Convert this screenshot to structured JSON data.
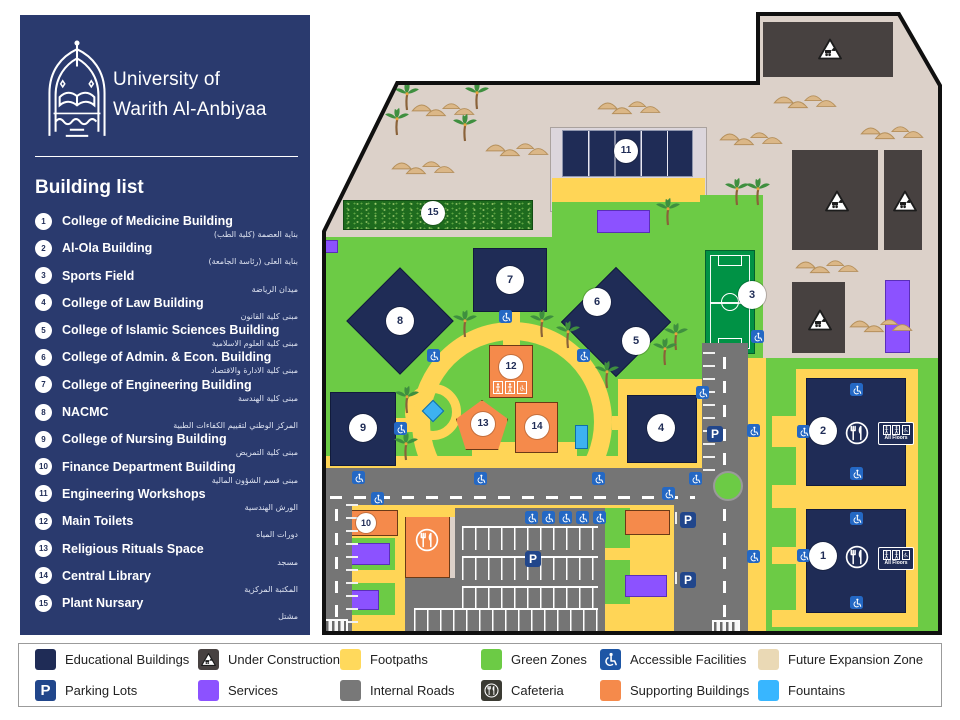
{
  "colors": {
    "navy": "#2A3A6E",
    "bldg": "#1F2C56",
    "green": "#6CCB45",
    "yellow": "#FFD556",
    "beige": "#DCD1C9",
    "beige_legend": "#EAD9B5",
    "orange": "#F58A4B",
    "purple": "#8C52FF",
    "road": "#757575",
    "dark": "#474140",
    "blue": "#3DB2F0",
    "access": "#2468C4",
    "field": "#009245"
  },
  "icons": {
    "accessible": "wheelchair-icon",
    "cafeteria": "fork-knife-icon",
    "under_construction": "excavator-warning-icon",
    "parking": "letter-p-badge",
    "logo": "university-crest",
    "palm": "palm-tree",
    "dunes": "sand-dunes",
    "gate": "entrance-gate"
  },
  "sidebar": {
    "title_line1": "University of",
    "title_line2": "Warith Al-Anbiyaa",
    "heading": "Building list",
    "buildings": [
      {
        "num": "1",
        "name": "College of Medicine Building",
        "ar": "بناية العصمة (كلية الطب)"
      },
      {
        "num": "2",
        "name": "Al-Ola Building",
        "ar": "بناية العلى (رئاسة الجامعة)"
      },
      {
        "num": "3",
        "name": "Sports Field",
        "ar": "ميدان الرياضة"
      },
      {
        "num": "4",
        "name": "College of Law Building",
        "ar": "مبنى كلية القانون"
      },
      {
        "num": "5",
        "name": "College of Islamic Sciences Building",
        "ar": "مبنى كلية العلوم الاسلامية"
      },
      {
        "num": "6",
        "name": "College of Admin. & Econ. Building",
        "ar": "مبنى كلية الادارة والاقتصاد"
      },
      {
        "num": "7",
        "name": "College of Engineering Building",
        "ar": "مبنى كلية الهندسة"
      },
      {
        "num": "8",
        "name": "NACMC",
        "ar": "المركز الوطني لتقييم الكفاءات الطبية"
      },
      {
        "num": "9",
        "name": "College of Nursing Building",
        "ar": "مبنى كلية التمريض"
      },
      {
        "num": "10",
        "name": "Finance Department Building",
        "ar": "مبنى قسم الشؤون المالية"
      },
      {
        "num": "11",
        "name": "Engineering Workshops",
        "ar": "الورش الهندسية"
      },
      {
        "num": "12",
        "name": "Main Toilets",
        "ar": "دورات المياه"
      },
      {
        "num": "13",
        "name": "Religious Rituals Space",
        "ar": "مسجد"
      },
      {
        "num": "14",
        "name": "Central Library",
        "ar": "المكتبة المركزية"
      },
      {
        "num": "15",
        "name": "Plant Nursary",
        "ar": "مشتل"
      }
    ]
  },
  "map": {
    "parking_label": "P",
    "all_floors_label": "All Floors"
  },
  "legend": {
    "items": [
      {
        "label": "Educational Buildings",
        "swatch": "navy"
      },
      {
        "label": "Under Construction",
        "swatch": "dark"
      },
      {
        "label": "Footpaths",
        "swatch": "yellow"
      },
      {
        "label": "Green Zones",
        "swatch": "green"
      },
      {
        "label": "Accessible Facilities",
        "swatch": "access"
      },
      {
        "label": "Future Expansion Zone",
        "swatch": "beige"
      },
      {
        "label": "Parking Lots",
        "swatch": "parking"
      },
      {
        "label": "Services",
        "swatch": "purple"
      },
      {
        "label": "Internal Roads",
        "swatch": "gray"
      },
      {
        "label": "Cafeteria",
        "swatch": "cafeteria"
      },
      {
        "label": "Supporting Buildings",
        "swatch": "orange"
      },
      {
        "label": "Fountains",
        "swatch": "blue"
      }
    ]
  }
}
